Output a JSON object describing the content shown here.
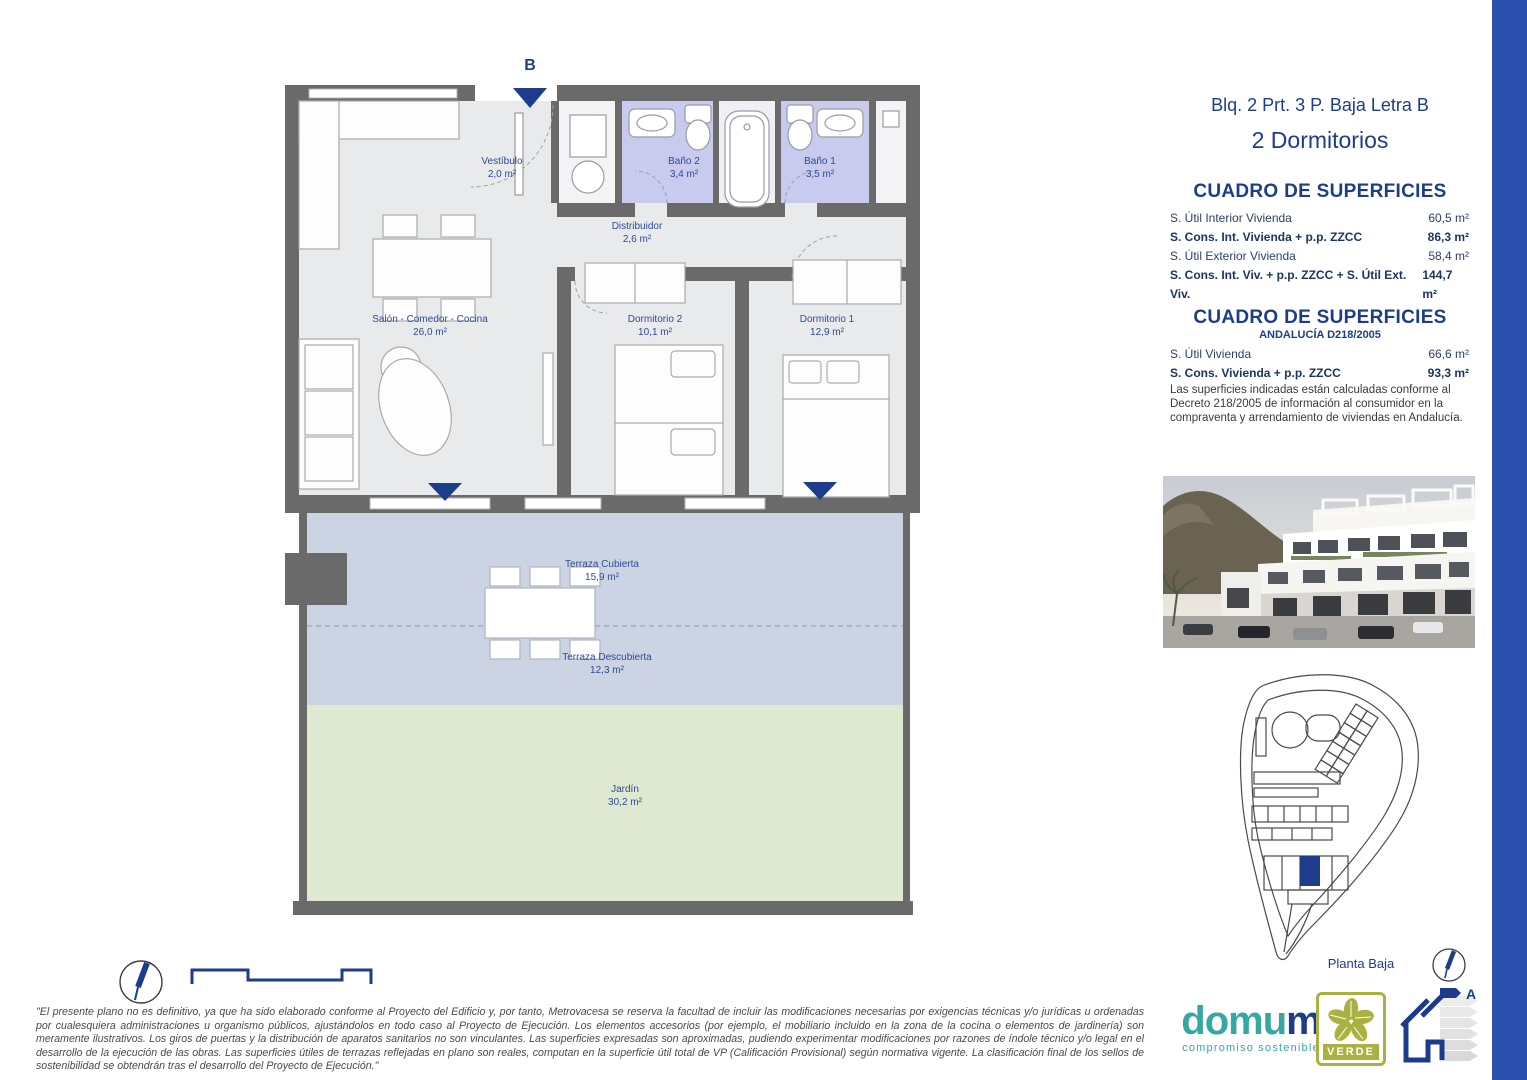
{
  "header": {
    "plan_ref": "Blq. 2 Prt. 3 P. Baja Letra B",
    "bedrooms": "2 Dormitorios"
  },
  "surfaces_table": {
    "title": "CUADRO DE SUPERFICIES",
    "rows": [
      {
        "label": "S. Útil Interior Vivienda",
        "value": "60,5 m²"
      },
      {
        "label": "S. Cons. Int. Vivienda + p.p. ZZCC",
        "value": "86,3 m²"
      },
      {
        "label": "S. Útil Exterior Vivienda",
        "value": "58,4 m²"
      },
      {
        "label": "S. Cons. Int. Viv. + p.p. ZZCC + S. Útil Ext. Viv.",
        "value": "144,7 m²"
      }
    ]
  },
  "andalucia_table": {
    "title": "CUADRO DE SUPERFICIES",
    "subtitle": "ANDALUCÍA D218/2005",
    "rows": [
      {
        "label": "S. Útil Vivienda",
        "value": "66,6 m²"
      },
      {
        "label": "S. Cons. Vivienda + p.p. ZZCC",
        "value": "93,3 m²"
      }
    ],
    "note": "Las superficies indicadas están calculadas conforme al Decreto 218/2005 de información al consumidor en la compraventa y arrendamiento de viviendas en Andalucía."
  },
  "floor_plan": {
    "entrance_letter": "B",
    "rooms": {
      "vestibulo": {
        "name": "Vestíbulo",
        "area": "2,0 m²"
      },
      "bano2": {
        "name": "Baño 2",
        "area": "3,4 m²"
      },
      "bano1": {
        "name": "Baño 1",
        "area": "3,5 m²"
      },
      "distribuidor": {
        "name": "Distribuidor",
        "area": "2,6 m²"
      },
      "salon": {
        "name": "Salón - Comedor - Cocina",
        "area": "26,0 m²"
      },
      "dormitorio2": {
        "name": "Dormitorio 2",
        "area": "10,1 m²"
      },
      "dormitorio1": {
        "name": "Dormitorio 1",
        "area": "12,9 m²"
      },
      "terraza_cubierta": {
        "name": "Terraza Cubierta",
        "area": "15,9 m²"
      },
      "terraza_descubierta": {
        "name": "Terraza Descubierta",
        "area": "12,3 m²"
      },
      "jardin": {
        "name": "Jardín",
        "area": "30,2 m²"
      }
    }
  },
  "site_plan": {
    "label": "Planta Baja"
  },
  "branding": {
    "logo_part1": "domu",
    "logo_part2": "m",
    "tagline": "compromiso sostenible",
    "verde_label": "VERDE",
    "energy_rating": "A"
  },
  "disclaimer": "\"El presente plano no es definitivo, ya que ha sido elaborado conforme al Proyecto del Edificio y, por tanto, Metrovacesa se reserva la facultad de incluir las modificaciones necesarias por exigencias técnicas y/o jurídicas u ordenadas por cualesquiera administraciones u organismo públicos, ajustándolos en todo caso al Proyecto de Ejecución. Los elementos accesorios (por ejemplo, el mobiliario incluido en la zona de la cocina o elementos de jardinería) son meramente ilustrativos. Los giros de puertas y la distribución de aparatos sanitarios no son vinculantes. Las superficies expresadas son aproximadas, pudiendo experimentar modificaciones por razones de índole técnico y/o legal en el desarrollo de la ejecución de las obras. Las superficies útiles de terrazas reflejadas en plano son reales, computan en la superficie útil total de VP (Calificación Provisional) según normativa vigente. La clasificación final de los sellos de sostenibilidad se obtendrán tras el desarrollo del Proyecto de Ejecución.\"",
  "colors": {
    "accent_navy": "#1d3d8c",
    "right_bar_blue": "#2b4fae",
    "wall_gray": "#6a6a6a",
    "bathroom_purple": "#c8caee",
    "terrace_blue_gray": "#ccd3e2",
    "garden_green": "#dfe9d2",
    "brand_teal": "#35a8a2",
    "verde_olive": "#a9b23f"
  }
}
